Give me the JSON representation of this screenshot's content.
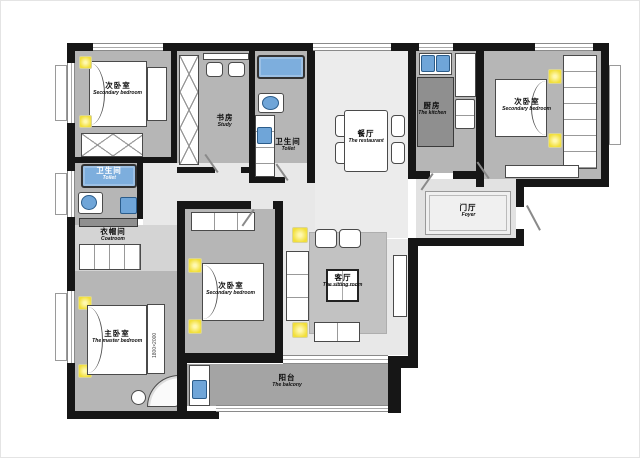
{
  "plan": {
    "type": "apartment-floor-plan",
    "colors": {
      "wall": "#161616",
      "room_floor_gray": "#b6b6b6",
      "hall_floor_light": "#e8e8e8",
      "balcony_gray": "#a4a4a4",
      "fixture_blue": "#6fa5d8",
      "lamp_yellow": "#f2df3a",
      "counter_dark": "#8f8f8f"
    }
  },
  "rooms": {
    "bedroom_tl": {
      "zh": "次卧室",
      "en": "Secondary bedroom"
    },
    "study": {
      "zh": "书房",
      "en": "Study"
    },
    "bath_top": {
      "zh": "卫生间",
      "en": "Toilet"
    },
    "dining": {
      "zh": "餐厅",
      "en": "The restaurant"
    },
    "kitchen": {
      "zh": "厨房",
      "en": "The kitchen"
    },
    "bedroom_tr": {
      "zh": "次卧室",
      "en": "Secondary bedroom"
    },
    "foyer": {
      "zh": "门厅",
      "en": "Foyer"
    },
    "bath_left": {
      "zh": "卫生间",
      "en": "Toilet"
    },
    "coatroom": {
      "zh": "衣帽间",
      "en": "Coatroom"
    },
    "master": {
      "zh": "主卧室",
      "en": "The master bedroom"
    },
    "bedroom_mid": {
      "zh": "次卧室",
      "en": "Secondary bedroom"
    },
    "sitting": {
      "zh": "客厅",
      "en": "The sitting room"
    },
    "balcony": {
      "zh": "阳台",
      "en": "The balcony"
    }
  },
  "annotations": {
    "master_bed_size": "1800×2000"
  }
}
